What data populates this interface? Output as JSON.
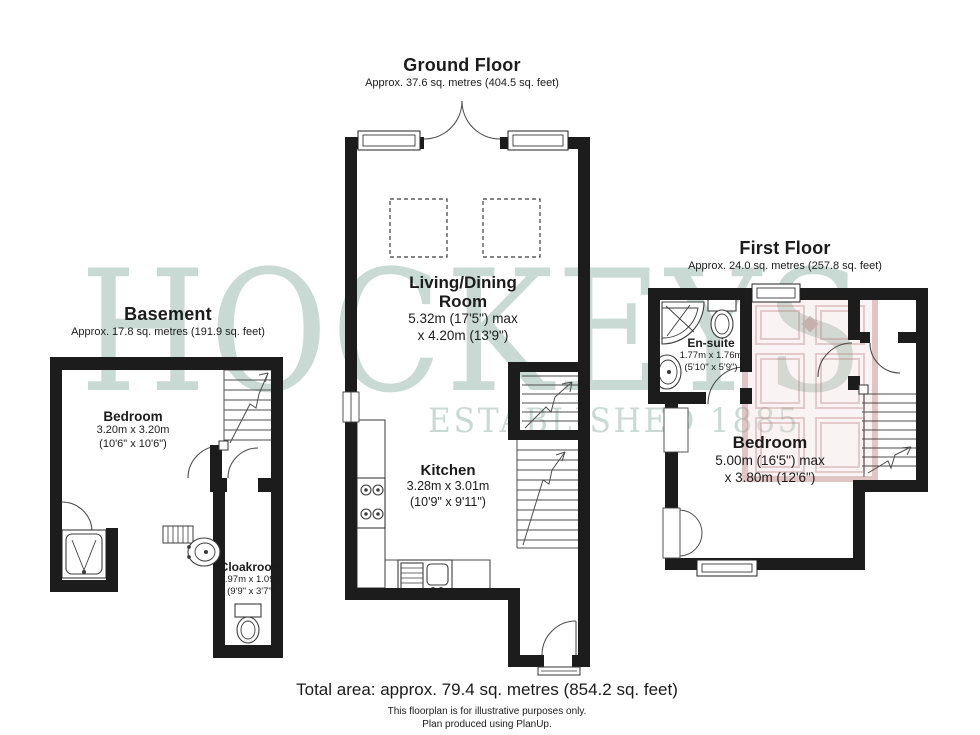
{
  "watermark": {
    "brand": "HOCKEYS",
    "established": "ESTABLISHED 1885",
    "green": "#9cbcb0",
    "door_red": "#c48a8a"
  },
  "colors": {
    "wall": "#1c1c1c",
    "thin_line": "#4d4d4d",
    "background": "#ffffff"
  },
  "floors": {
    "ground": {
      "title": "Ground Floor",
      "area": "Approx. 37.6 sq. metres (404.5 sq. feet)"
    },
    "basement": {
      "title": "Basement",
      "area": "Approx. 17.8 sq. metres (191.9 sq. feet)"
    },
    "first": {
      "title": "First Floor",
      "area": "Approx. 24.0 sq. metres (257.8 sq. feet)"
    }
  },
  "rooms": {
    "living": {
      "name": "Living/Dining Room",
      "dim1": "5.32m (17'5\") max",
      "dim2": "x 4.20m (13'9\")"
    },
    "kitchen": {
      "name": "Kitchen",
      "dim1": "3.28m x 3.01m",
      "dim2": "(10'9\" x 9'11\")"
    },
    "basement_bedroom": {
      "name": "Bedroom",
      "dim1": "3.20m x 3.20m",
      "dim2": "(10'6\" x 10'6\")"
    },
    "cloakroom": {
      "name": "Cloakroom",
      "dim1": "2.97m x 1.09m",
      "dim2": "(9'9\" x 3'7\")"
    },
    "ensuite": {
      "name": "En-suite",
      "dim1": "1.77m x 1.76m",
      "dim2": "(5'10\" x 5'9\")"
    },
    "first_bedroom": {
      "name": "Bedroom",
      "dim1": "5.00m (16'5\") max",
      "dim2": "x 3.80m (12'6\")"
    }
  },
  "footer": {
    "total": "Total area: approx. 79.4 sq. metres (854.2 sq. feet)",
    "disclaimer": "This floorplan is for illustrative purposes only.",
    "credit": "Plan produced using PlanUp."
  }
}
